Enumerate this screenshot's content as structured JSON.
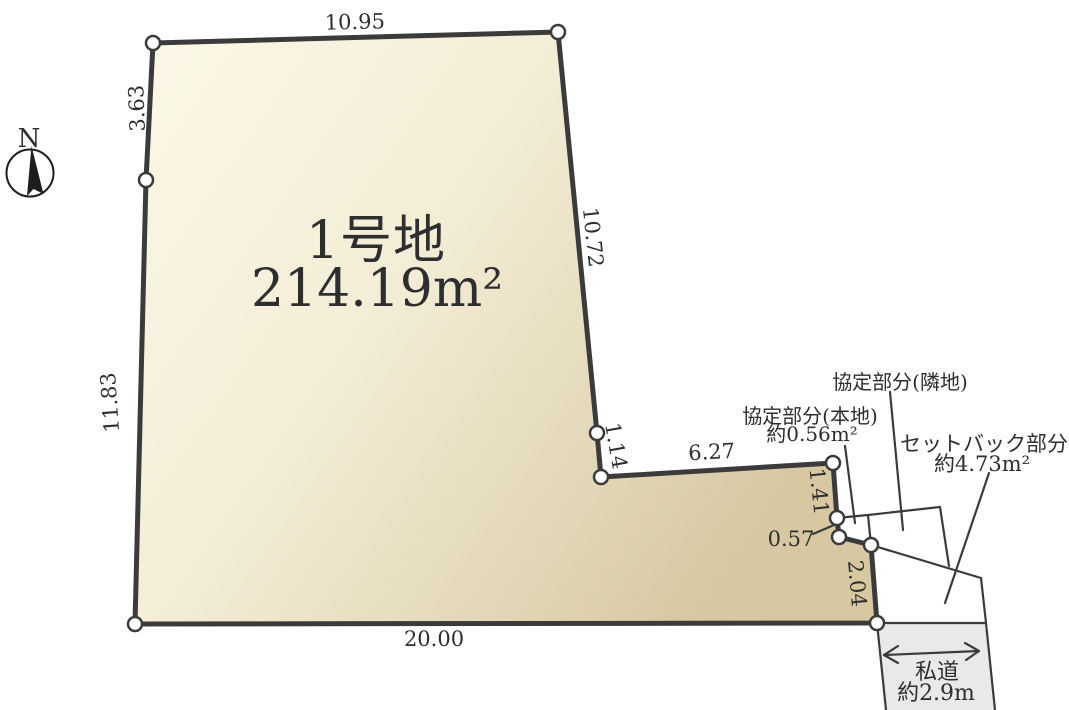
{
  "parcel": {
    "name": "1号地",
    "area": "214.19m²"
  },
  "dimensions": {
    "top": "10.95",
    "upper_left": "3.63",
    "left": "11.83",
    "right_upper": "10.72",
    "notch_step": "1.14",
    "notch_bottom": "6.27",
    "right_step1": "1.41",
    "right_step2": "0.57",
    "right_step3": "2.04",
    "bottom": "20.00"
  },
  "annotations": {
    "agreement_neighbor": "協定部分(隣地)",
    "agreement_subject": "協定部分(本地)",
    "agreement_subject_area": "約0.56m²",
    "setback": "セットバック部分",
    "setback_area": "約4.73m²",
    "road": "私道",
    "road_width": "約2.9m"
  },
  "compass": {
    "north_label": "N"
  },
  "colors": {
    "line": "#3b3b3c",
    "parcel_fill_light": "#fcf8e8",
    "parcel_fill_mid": "#f3edd6",
    "parcel_fill_dark": "#d7c8a2",
    "road_fill": "#e9e9eb",
    "text": "#2e2e2e"
  }
}
